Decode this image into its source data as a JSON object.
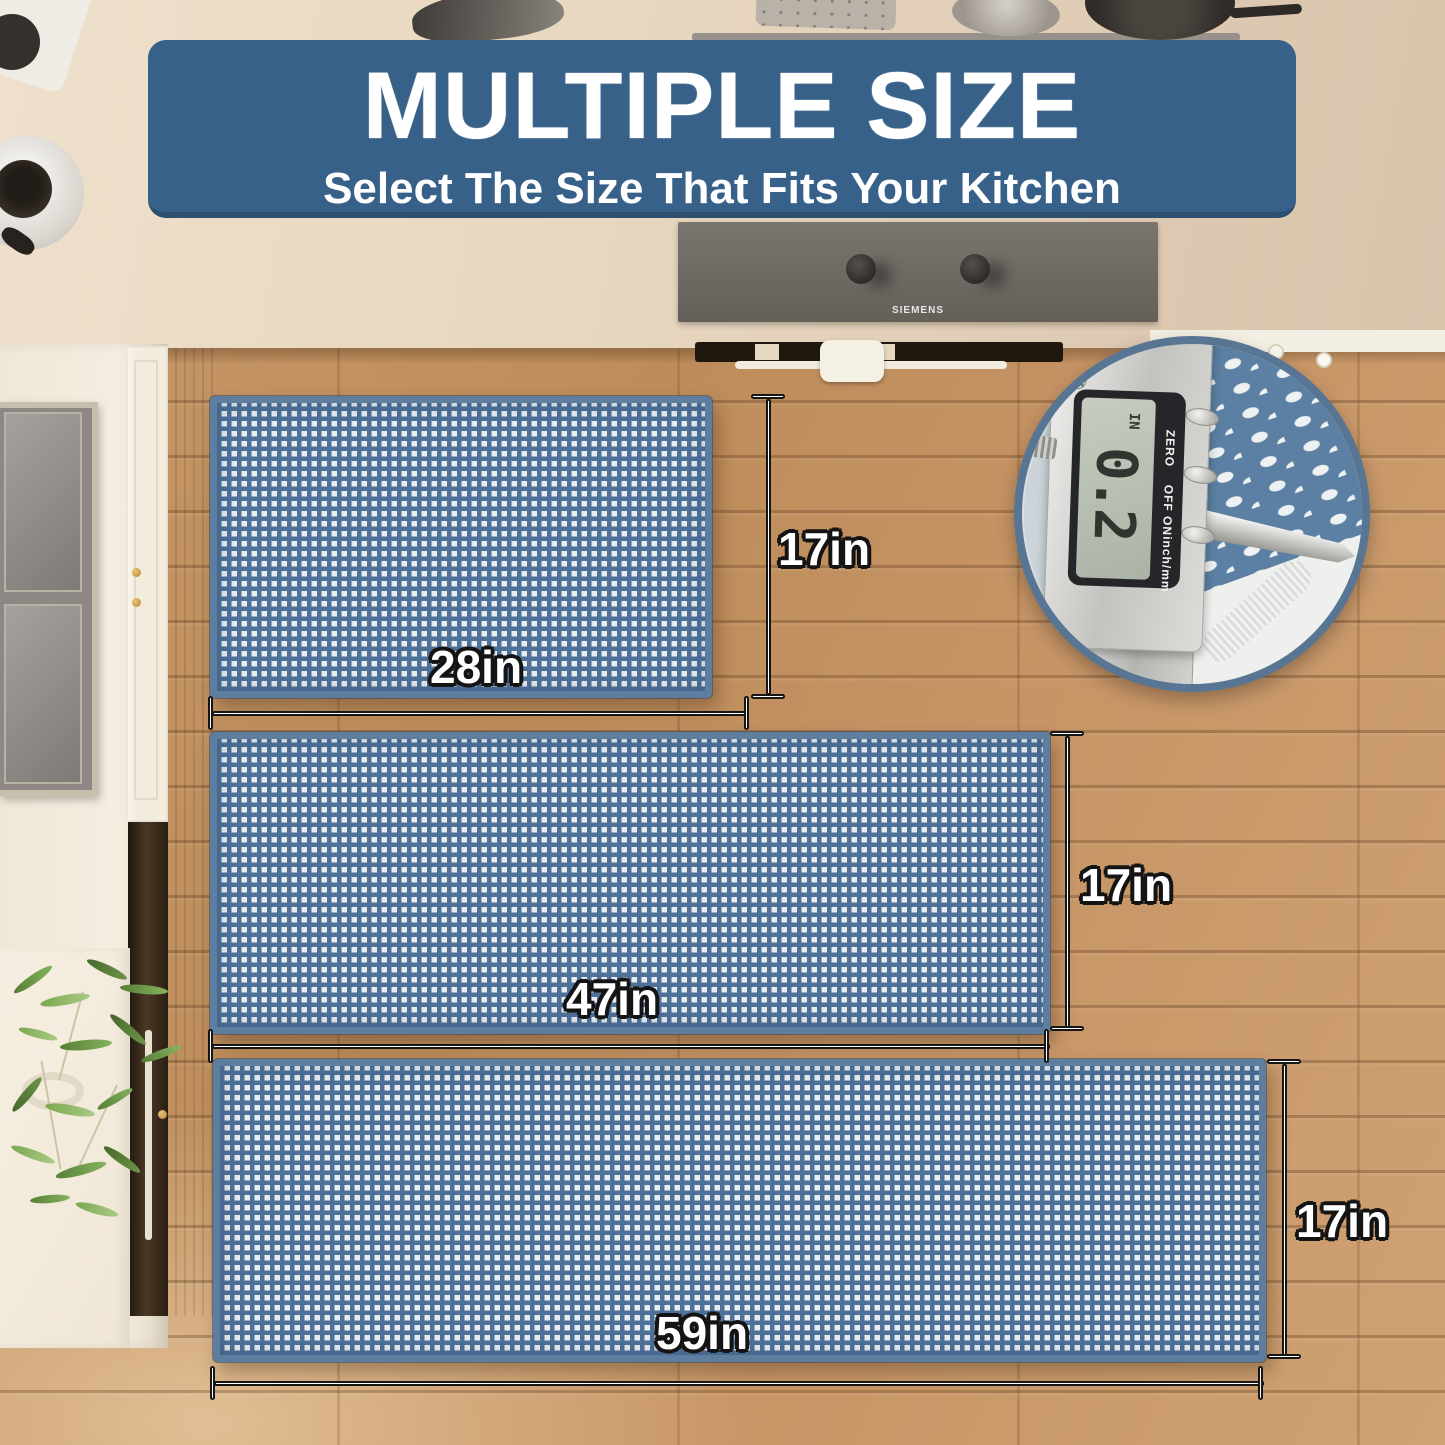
{
  "banner": {
    "title": "MULTIPLE SIZE",
    "subtitle": "Select The Size That Fits Your Kitchen"
  },
  "mats": [
    {
      "id": "small",
      "width_label": "28in",
      "height_label": "17in"
    },
    {
      "id": "medium",
      "width_label": "47in",
      "height_label": "17in"
    },
    {
      "id": "large",
      "width_label": "59in",
      "height_label": "17in"
    }
  ],
  "caliper": {
    "reading": "0.2",
    "unit": "IN",
    "labels": {
      "zero": "ZERO",
      "power": "OFF  ON",
      "mode": "inch/mm"
    }
  },
  "stove": {
    "brand": "SIEMENS"
  },
  "colors": {
    "banner_blue": "#386189",
    "mat_blue": "#4d7199",
    "mat_square_white": "#e9edef",
    "mat_edge_blue": "#5d7e9f",
    "inset_ring_blue": "#587694",
    "dimension_text": "#ffffff",
    "dimension_outline": "#161616",
    "floor_wood": "#c29263"
  }
}
